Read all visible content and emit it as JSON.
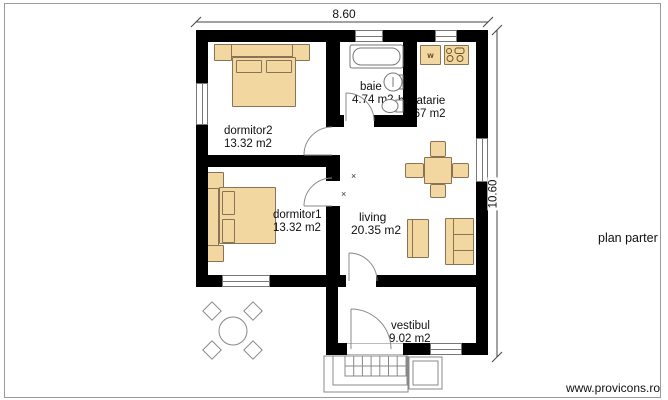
{
  "labels": {
    "title": "plan parter",
    "watermark": "www.provicons.ro"
  },
  "dimensions": {
    "width": "8.60",
    "height": "10.60"
  },
  "rooms": [
    {
      "id": "dormitor2",
      "name": "dormitor2",
      "area": "13.32 m2"
    },
    {
      "id": "dormitor1",
      "name": "dormitor1",
      "area": "13.32 m2"
    },
    {
      "id": "baie",
      "name": "baie",
      "area": "4.74 m2"
    },
    {
      "id": "bucatarie",
      "name": "bucatarie",
      "area": "4.67 m2"
    },
    {
      "id": "living",
      "name": "living",
      "area": "20.35 m2"
    },
    {
      "id": "vestibul",
      "name": "vestibul",
      "area": "9.02 m2"
    }
  ],
  "markers": {
    "washer": "w",
    "cross": "×"
  },
  "colors": {
    "wall": "#000000",
    "furniture_fill": "#f2d7a0",
    "furniture_border": "#8a7355",
    "outline_gray": "#888888"
  }
}
